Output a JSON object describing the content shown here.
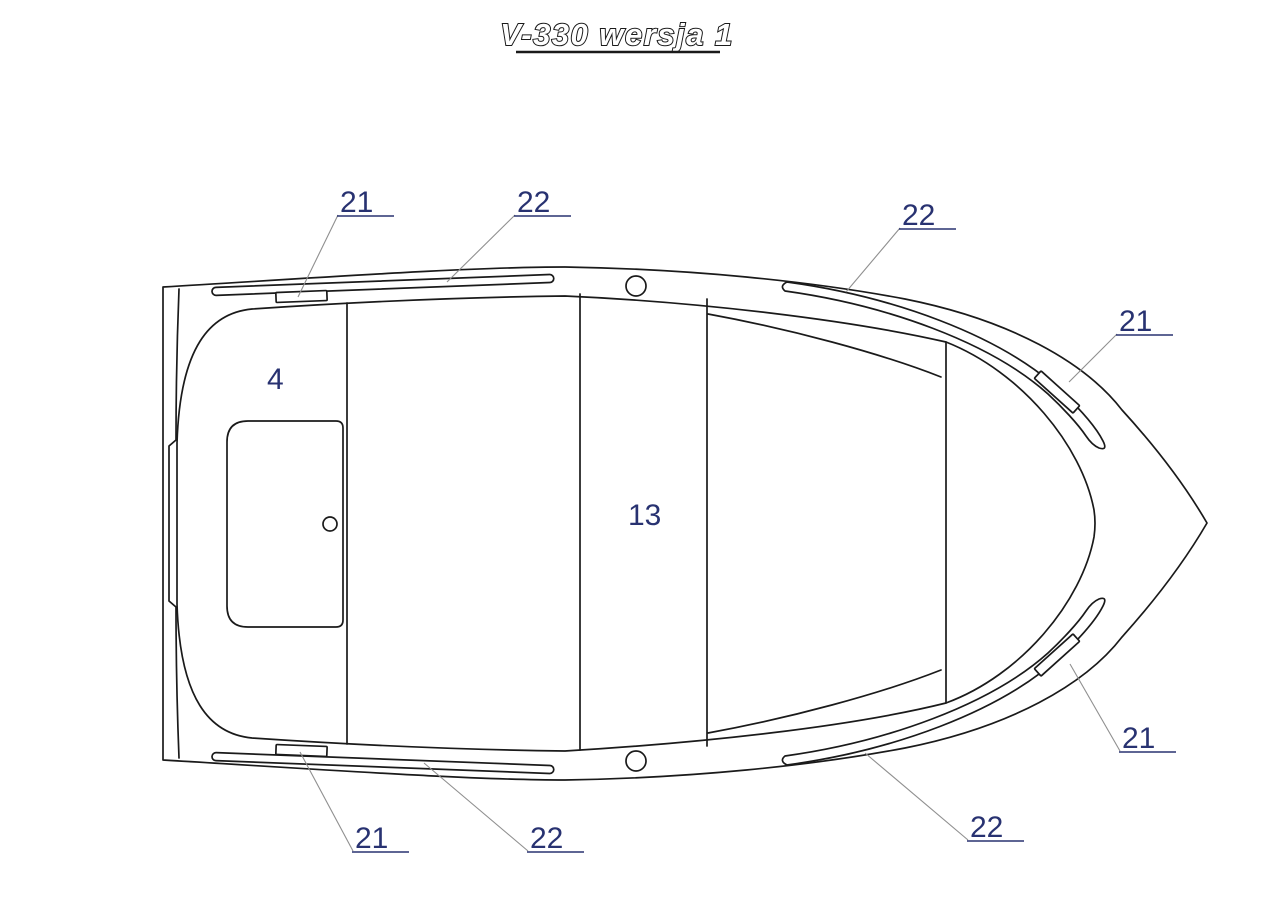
{
  "title": {
    "text": "V-330 wersja 1"
  },
  "colors": {
    "background": "#ffffff",
    "drawing_line": "#1a1a1a",
    "callout_label": "#283271",
    "leader_line": "#8f8f8f"
  },
  "drawing": {
    "kind": "technical line drawing",
    "subject": "boat hull top view"
  },
  "callouts": [
    {
      "text": "21",
      "position": "top-left-gunwale"
    },
    {
      "text": "22",
      "position": "top-center-gunwale"
    },
    {
      "text": "22",
      "position": "top-right-gunwale"
    },
    {
      "text": "21",
      "position": "bow-top"
    },
    {
      "text": "4",
      "position": "stern-deck"
    },
    {
      "text": "13",
      "position": "center-thwart"
    },
    {
      "text": "21",
      "position": "bottom-left-gunwale"
    },
    {
      "text": "22",
      "position": "bottom-center-gunwale"
    },
    {
      "text": "22",
      "position": "bottom-right-gunwale"
    },
    {
      "text": "21",
      "position": "bow-bottom"
    }
  ]
}
